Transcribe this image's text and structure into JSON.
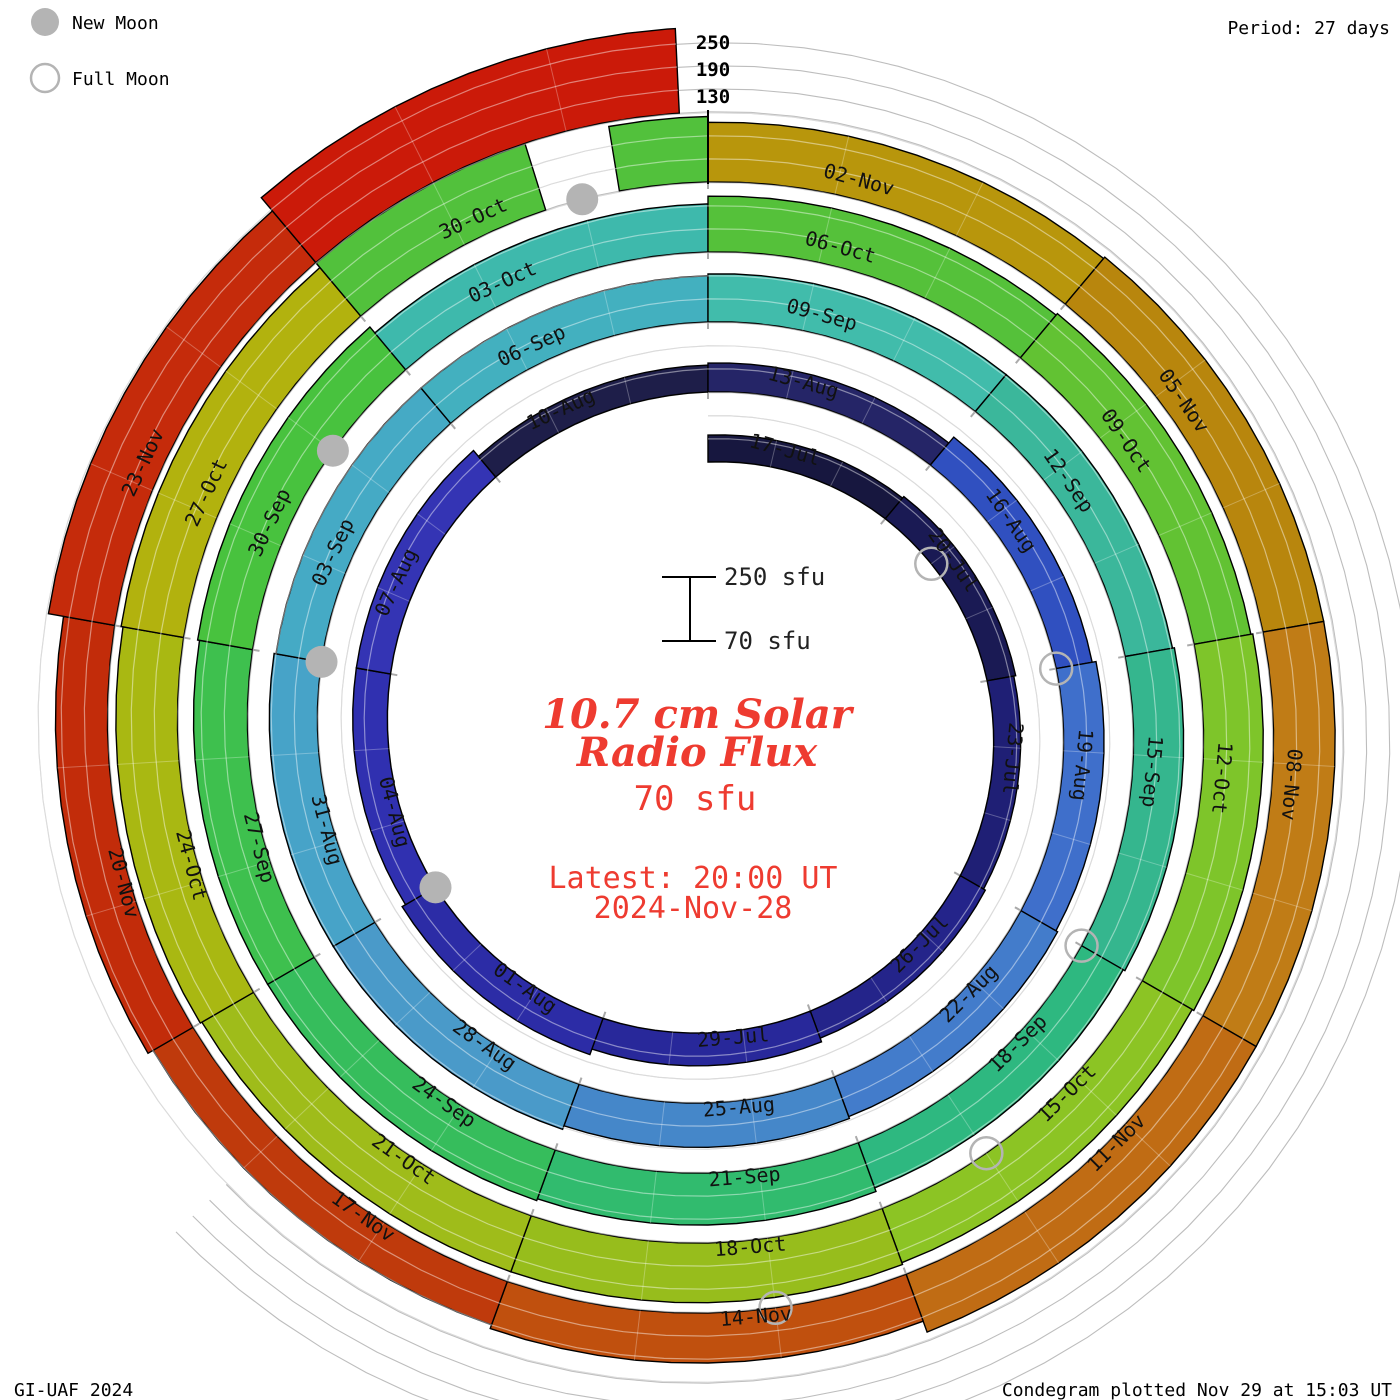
{
  "legend": {
    "new_moon_label": "New Moon",
    "full_moon_label": "Full Moon",
    "moon_color": "#b4b4b4"
  },
  "header": {
    "period_label": "Period: 27 days"
  },
  "footer": {
    "credit": "GI-UAF 2024",
    "plotted": "Condegram plotted Nov 29 at 15:03 UT"
  },
  "flux_axis": {
    "top_tick_labels": [
      "250",
      "190",
      "130"
    ],
    "scalebar_top_label": "250 sfu",
    "scalebar_bottom_label": "70 sfu"
  },
  "center_text": {
    "title_line1": "10.7 cm Solar",
    "title_line2": "Radio Flux",
    "current_value": "70 sfu",
    "latest_line1": "Latest: 20:00 UT",
    "latest_line2": "2024-Nov-28",
    "accent_color": "#ee3b30"
  },
  "chart_data": {
    "type": "spiral-bar-condegram",
    "title": "10.7 cm Solar Radio Flux",
    "period_days": 27,
    "days_per_segment": 3,
    "start_date": "17-Jul-2024",
    "end_date": "28-Nov-2024 20:00 UT",
    "flux_unit": "sfu",
    "flux_baseline": 70,
    "flux_gridlines": [
      130,
      190,
      250
    ],
    "segments": [
      {
        "date": "17-Jul",
        "sfu": 140,
        "color": "#17173f"
      },
      {
        "date": "20-Jul",
        "sfu": 145,
        "color": "#1a1a54"
      },
      {
        "date": "23-Jul",
        "sfu": 140,
        "color": "#1f1f75"
      },
      {
        "date": "26-Jul",
        "sfu": 145,
        "color": "#24248a"
      },
      {
        "date": "29-Jul",
        "sfu": 155,
        "color": "#28289a"
      },
      {
        "date": "01-Aug",
        "sfu": 170,
        "color": "#2c2ca6"
      },
      {
        "date": "04-Aug",
        "sfu": 160,
        "color": "#3030b0"
      },
      {
        "date": "07-Aug",
        "sfu": 160,
        "color": "#3434b4"
      },
      {
        "date": "10-Aug",
        "sfu": 140,
        "color": "#1e1e49"
      },
      {
        "date": "13-Aug",
        "sfu": 145,
        "color": "#252567"
      },
      {
        "date": "16-Aug",
        "sfu": 165,
        "color": "#3050c0"
      },
      {
        "date": "19-Aug",
        "sfu": 175,
        "color": "#3f6fcb"
      },
      {
        "date": "22-Aug",
        "sfu": 180,
        "color": "#437ccb"
      },
      {
        "date": "25-Aug",
        "sfu": 185,
        "color": "#4587c9"
      },
      {
        "date": "28-Aug",
        "sfu": 195,
        "color": "#4a9ac9"
      },
      {
        "date": "31-Aug",
        "sfu": 195,
        "color": "#47a3c8"
      },
      {
        "date": "03-Sep",
        "sfu": 190,
        "color": "#45aac5"
      },
      {
        "date": "06-Sep",
        "sfu": 190,
        "color": "#43b0bf"
      },
      {
        "date": "09-Sep",
        "sfu": 195,
        "color": "#41bcab"
      },
      {
        "date": "12-Sep",
        "sfu": 195,
        "color": "#3bb79b"
      },
      {
        "date": "15-Sep",
        "sfu": 200,
        "color": "#35b68e"
      },
      {
        "date": "18-Sep",
        "sfu": 195,
        "color": "#2eb880"
      },
      {
        "date": "21-Sep",
        "sfu": 205,
        "color": "#31bb6e"
      },
      {
        "date": "24-Sep",
        "sfu": 210,
        "color": "#36bd5c"
      },
      {
        "date": "27-Sep",
        "sfu": 210,
        "color": "#3ec04e"
      },
      {
        "date": "30-Sep",
        "sfu": 215,
        "color": "#48c23e"
      },
      {
        "date": "03-Oct",
        "sfu": 195,
        "color": "#3eb9ac"
      },
      {
        "date": "06-Oct",
        "sfu": 215,
        "color": "#55c13a"
      },
      {
        "date": "09-Oct",
        "sfu": 220,
        "color": "#62c233"
      },
      {
        "date": "12-Oct",
        "sfu": 225,
        "color": "#7ec52a"
      },
      {
        "date": "15-Oct",
        "sfu": 220,
        "color": "#8cc424"
      },
      {
        "date": "18-Oct",
        "sfu": 225,
        "color": "#97bd1c"
      },
      {
        "date": "21-Oct",
        "sfu": 225,
        "color": "#9fbc1a"
      },
      {
        "date": "24-Oct",
        "sfu": 230,
        "color": "#a9b812"
      },
      {
        "date": "27-Oct",
        "sfu": 235,
        "color": "#b2b20e"
      },
      {
        "date": "30-Oct",
        "sfu": 250,
        "color": "#52c13c",
        "parts": [
          {
            "d0": 0,
            "d1": 1.7,
            "sfu": 250
          },
          {
            "d0": 1.7,
            "d1": 2.3,
            "sfu": 72
          },
          {
            "d0": 2.3,
            "d1": 3,
            "sfu": 240
          }
        ]
      },
      {
        "date": "02-Nov",
        "sfu": 225,
        "color": "#b8960c"
      },
      {
        "date": "05-Nov",
        "sfu": 230,
        "color": "#b8860d"
      },
      {
        "date": "08-Nov",
        "sfu": 230,
        "color": "#c07c16"
      },
      {
        "date": "11-Nov",
        "sfu": 230,
        "color": "#c06c14"
      },
      {
        "date": "14-Nov",
        "sfu": 200,
        "color": "#c0500e"
      },
      {
        "date": "17-Nov",
        "sfu": 190,
        "color": "#bf3a0c"
      },
      {
        "date": "20-Nov",
        "sfu": 205,
        "color": "#c22c0a"
      },
      {
        "date": "23-Nov",
        "sfu": 245,
        "color": "#c52b0b"
      },
      {
        "date": "26-Nov",
        "sfu": 290,
        "color": "#cb1a09",
        "label_visible": false
      }
    ],
    "end_day": 134.8,
    "moons": {
      "new": [
        {
          "date": "04-Aug",
          "day": 18
        },
        {
          "date": "03-Sep",
          "day": 48
        },
        {
          "date": "02-Oct",
          "day": 77
        },
        {
          "date": "01-Nov",
          "day": 107
        }
      ],
      "full": [
        {
          "date": "21-Jul",
          "day": 4
        },
        {
          "date": "19-Aug",
          "day": 33
        },
        {
          "date": "18-Sep",
          "day": 63
        },
        {
          "date": "17-Oct",
          "day": 92
        },
        {
          "date": "15-Nov",
          "day": 121
        }
      ]
    }
  }
}
